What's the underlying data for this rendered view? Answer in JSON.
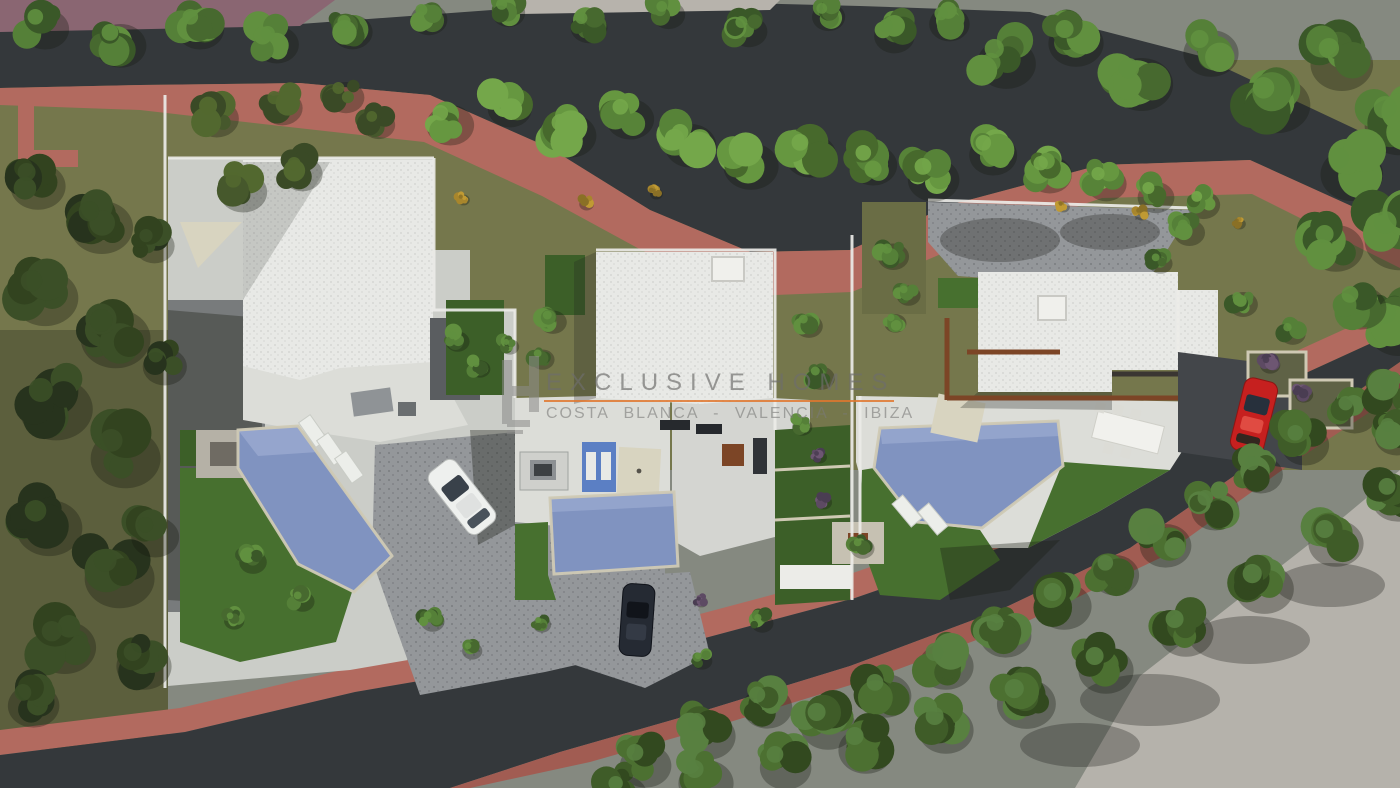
{
  "watermark": {
    "title": "EXCLUSIVE HOMES",
    "subtitle": "COSTA BLANCA - VALENCIA - IBIZA",
    "title_color": "#6e6e6c",
    "subtitle_color": "#7a7a78",
    "underline_color": "#e0772e",
    "logo_color": "#8b8b89",
    "logo": "EH-monogram"
  },
  "scene": {
    "type": "aerial-3d-site-plan-render",
    "description": "Top-down 3D architectural visualization of a hillside residential development: three modern flat-roof villas with private swimming pools, lawns, cobbled driveways and gardens, bounded above and below by curving dark asphalt roads with salmon-pink sidewalks and dense rows of trees.",
    "villas": [
      {
        "name": "villa-west",
        "features": [
          "white flat roof",
          "angled swimming pool",
          "lawns",
          "shade sail",
          "stone fire-pit terrace",
          "white car in driveway"
        ]
      },
      {
        "name": "villa-center",
        "features": [
          "white flat roof with skylight",
          "rectangular pool",
          "blue tiled pool wall",
          "parasol",
          "dark car at entrance drive"
        ]
      },
      {
        "name": "villa-east",
        "features": [
          "white flat roof",
          "rust pergola beams",
          "angled pool",
          "outdoor dining table",
          "cobbled forecourt",
          "red car parked at street"
        ]
      }
    ],
    "cars": [
      {
        "name": "white-car"
      },
      {
        "name": "dark-car"
      },
      {
        "name": "red-car"
      }
    ],
    "roads": [
      {
        "name": "upper-road",
        "surface": "asphalt",
        "sidewalk": "salmon-pink"
      },
      {
        "name": "lower-road",
        "surface": "asphalt",
        "sidewalk": "salmon-pink"
      }
    ]
  },
  "palette": {
    "asphalt": "#34383b",
    "sidewalk": "#b26a5f",
    "sidewalk2": "#a15c52",
    "mauve": "#8a6672",
    "olive": "#75774c",
    "olive2": "#5c5f3d",
    "plot": "#cbcdc8",
    "terrace": "#dcddd8",
    "roof": "#e8e9e6",
    "cobble": "#94979a",
    "pool": "#8093c0",
    "pool2": "#9aaad0",
    "pooltile": "#5b7fc4",
    "coping": "#cfc9b4",
    "lawn": "#47702f",
    "lawn2": "#3c5f28",
    "concrete": "#b5b2ab",
    "wall": "#ecece8",
    "rust": "#7c4526",
    "sail": "#d8d4c0",
    "carwhite": "#eef0ee",
    "cardark": "#252a33",
    "carred": "#c6201f"
  },
  "foliage": {
    "D": [
      "#27331d",
      "#32431f",
      "#3b4f27"
    ],
    "O": [
      "#3a4a26",
      "#46582c",
      "#52682f"
    ],
    "M": [
      "#3a5828",
      "#47692f",
      "#558038",
      "#61903f"
    ],
    "B": [
      "#47692c",
      "#578338",
      "#669740",
      "#74a74a"
    ],
    "H": [
      "#32491f",
      "#3f5c28",
      "#4c7031",
      "#588040"
    ],
    "P": [
      "#5d4a63",
      "#6d5672",
      "#4a3d52"
    ],
    "Y": [
      "#a8862c",
      "#c09a33",
      "#8a7026"
    ]
  }
}
